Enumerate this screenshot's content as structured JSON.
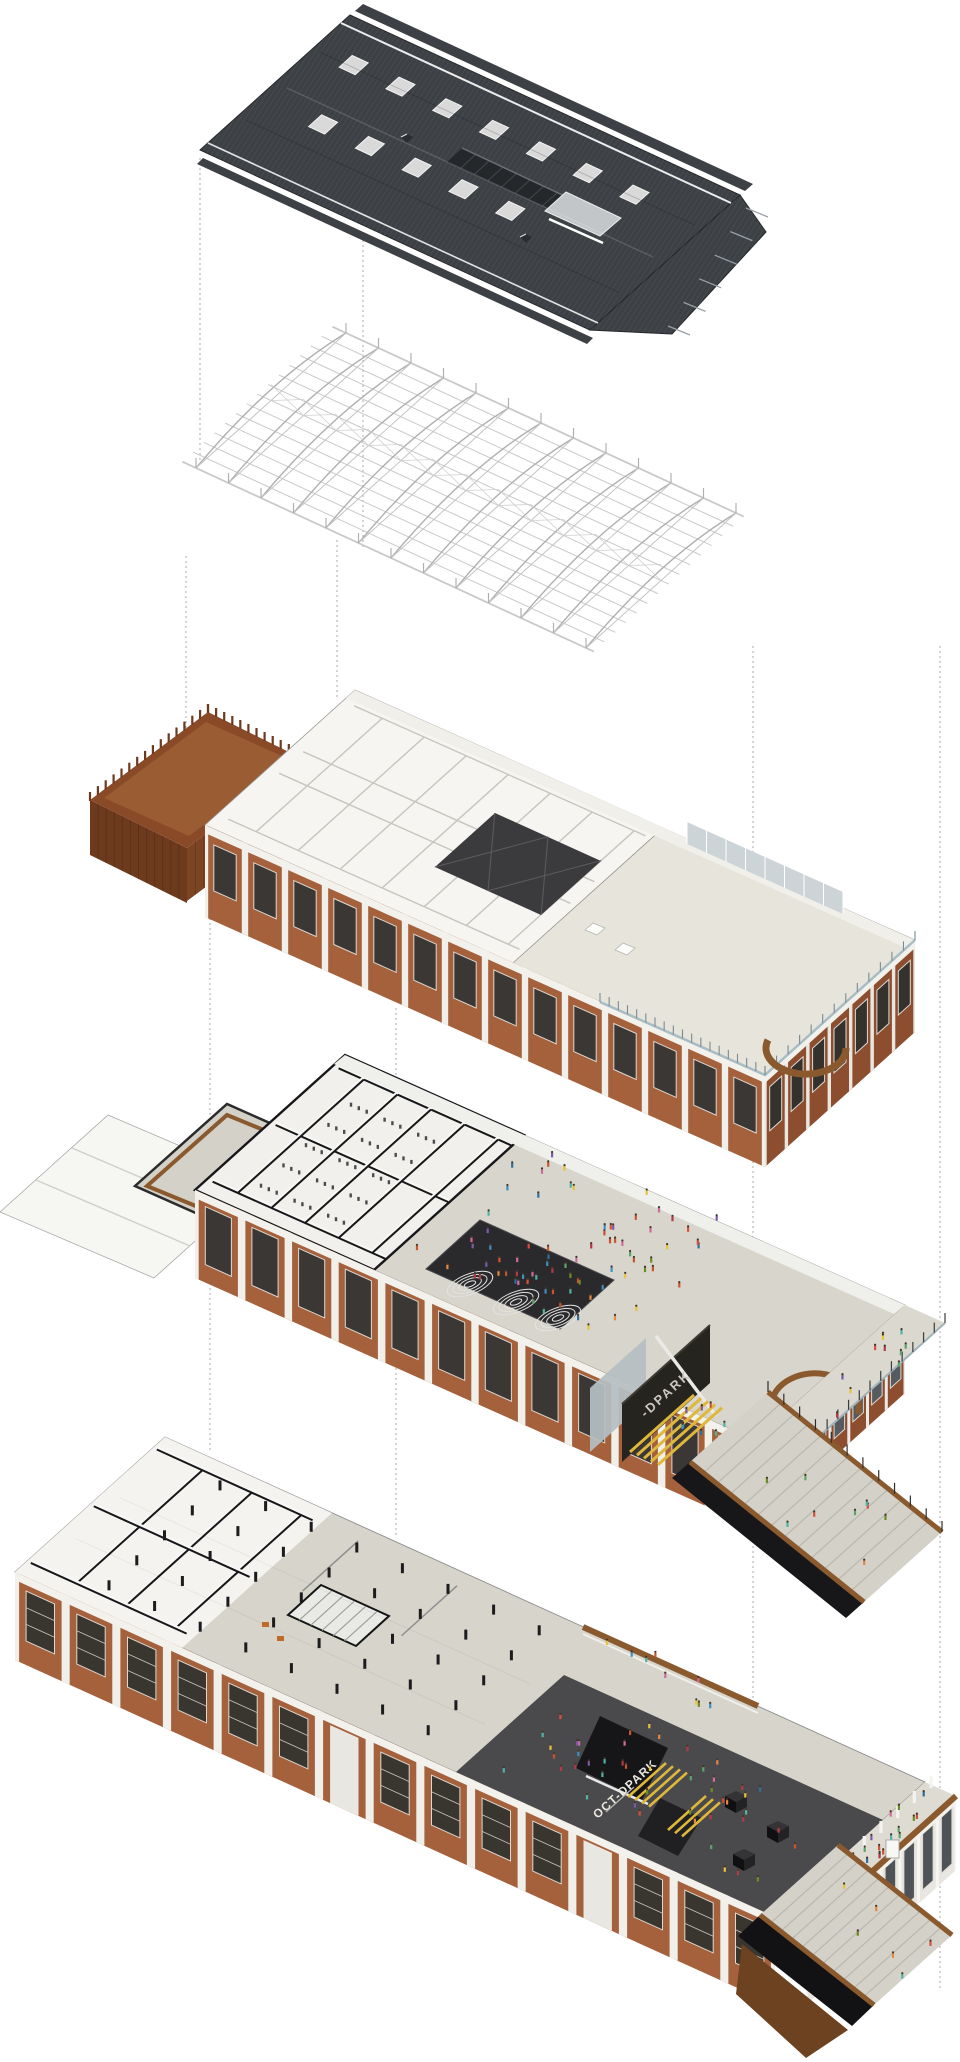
{
  "figure": {
    "type": "exploded-axonometric-architecture-diagram",
    "description": "Five exploded levels of a renovated brick factory building: corrugated roof, steel roof trusses, attic floor with timber-fenced deck, exhibition floor with sunken black hall and grand stair, ground floor with column hall and dark event plaza.",
    "background": "#ffffff"
  },
  "signs": {
    "exhibition_wall": "-DPARK",
    "plaza_floor": "OCT-DPARK"
  },
  "palette": {
    "roof": "#3d4145",
    "roof_hatch": "#51565c",
    "truss": "#b7b7b7",
    "brick": "#a5603c",
    "brick_dark": "#8d4e2f",
    "pier_white": "#f1efe9",
    "wood": "#8a5a2e",
    "wood_dark": "#6d4220",
    "fence": "#8a4a28",
    "fence_side": "#6e3a1e",
    "fence_inner": "#9a5c32",
    "floor_white": "#f6f5f1",
    "floor_light": "#e7e5db",
    "floor_gray": "#d6d4cb",
    "courtyard": "#d8d5cc",
    "plaza_dark": "#4a4a4c",
    "hall_black": "#2a2a2c",
    "pyramid": "#3b3b3d",
    "skylight": "#d9d9d9",
    "glass_pane": "#b5bec3",
    "glass_rail": "#a8bcc3",
    "glazing": "#ccd4d7",
    "yellow": "#ddb83a",
    "section_black": "#17171a",
    "stair_gray": "#d3d1c8",
    "line_gray": "#a8a8a8"
  },
  "layers": [
    {
      "id": "roof",
      "label": "corrugated metal roof with skylights and ridge monitor"
    },
    {
      "id": "trusses",
      "label": "steel roof truss grid"
    },
    {
      "id": "attic",
      "label": "attic floor with partition rooms, pyramid skylights, terrace and timber-fenced deck"
    },
    {
      "id": "exhibition",
      "label": "exhibition floor with sunken black hall, forum, grand stair and crowds"
    },
    {
      "id": "ground",
      "label": "ground floor with column hall, dark event plaza, gallery and entry stair"
    }
  ],
  "people_colors": [
    "#d94f3d",
    "#e38742",
    "#e8c23a",
    "#5aa469",
    "#3f8fbf",
    "#7a5ba8",
    "#d16a9e",
    "#4fb3a5",
    "#b23a48",
    "#6b8e23",
    "#2f6f9f",
    "#c9552f"
  ],
  "projection_lines": [
    {
      "x": 200,
      "y1": 158,
      "y2": 462
    },
    {
      "x": 363,
      "y1": 240,
      "y2": 548
    },
    {
      "x": 186,
      "y1": 556,
      "y2": 806
    },
    {
      "x": 337,
      "y1": 540,
      "y2": 700
    },
    {
      "x": 210,
      "y1": 878,
      "y2": 1452
    },
    {
      "x": 396,
      "y1": 1008,
      "y2": 1538
    },
    {
      "x": 753,
      "y1": 646,
      "y2": 1798
    },
    {
      "x": 940,
      "y1": 646,
      "y2": 1990
    }
  ]
}
